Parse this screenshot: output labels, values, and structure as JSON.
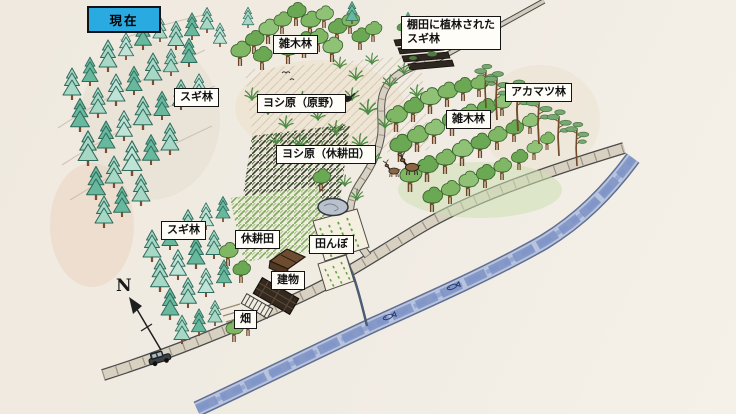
{
  "status_box": {
    "text": "現在"
  },
  "compass": {
    "north": "N"
  },
  "labels": {
    "zokibayashi_top": "雑木林",
    "sugibayashi_upper": "スギ林",
    "yoshihara_genya": "ヨシ原（原野）",
    "tanada_sugi_line1": "棚田に植林された",
    "tanada_sugi_line2": "スギ林",
    "akamatsu": "アカマツ林",
    "zokibayashi_right": "雑木林",
    "yoshihara_kyukoden": "ヨシ原（休耕田）",
    "sugibayashi_lower": "スギ林",
    "kyukoden": "休耕田",
    "tanbo": "田んぼ",
    "tatemono": "建物",
    "hatake": "畑"
  },
  "icons": {
    "compass": "north-arrow-icon",
    "car": "car-icon",
    "deer": "deer-icon",
    "fish": "fish-icon",
    "bird": "bird-icon"
  },
  "colors": {
    "status_bg": "#29abe2",
    "paper": "#f1ece3",
    "river": "#6d83b5",
    "road_edge": "#4a4a4a",
    "road_fill": "#d8d1c1",
    "cedar_light": "#a6d8c5",
    "cedar_dark": "#68b89d",
    "broadleaf": "#7fb765",
    "pine": "#79a872",
    "hatch_dark": "#39402e",
    "hatch_green": "#82ac62"
  }
}
